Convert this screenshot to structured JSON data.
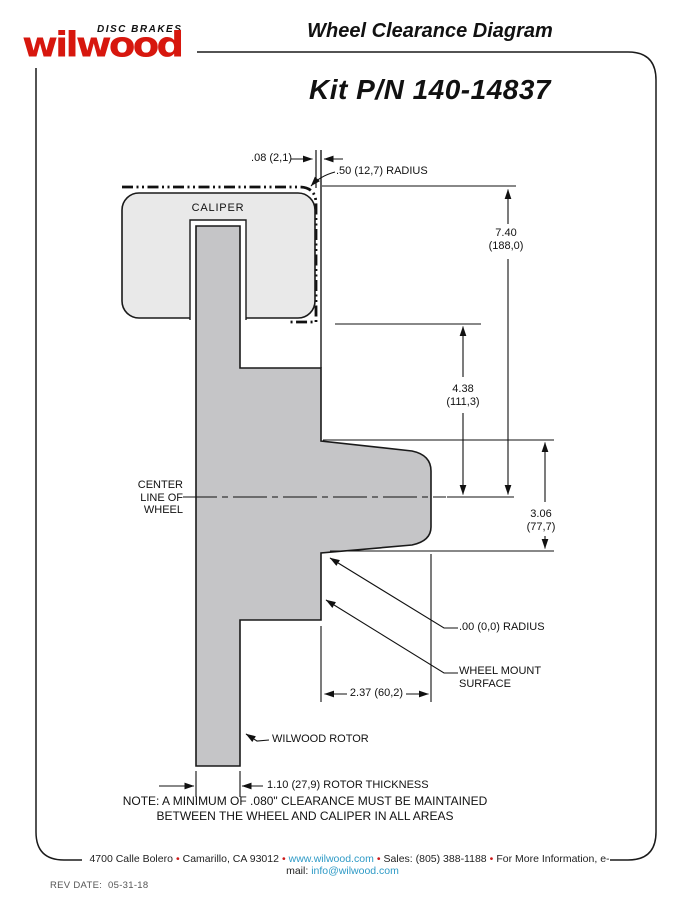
{
  "header": {
    "brand_tagline": "DISC BRAKES",
    "brand_name": "wilwood",
    "doc_title": "Wheel Clearance Diagram",
    "kit_number": "Kit P/N 140-14837"
  },
  "diagram": {
    "caliper_label": "CALIPER",
    "centerline_label": "CENTER\nLINE OF\nWHEEL",
    "rotor_label": "WILWOOD ROTOR",
    "wheel_mount_label": "WHEEL MOUNT\nSURFACE",
    "dims": {
      "clearance_gap": ".08 (2,1)",
      "corner_radius": ".50 (12,7) RADIUS",
      "wheel_radius_in": "7.40",
      "wheel_radius_mm": "(188,0)",
      "caliper_to_center_in": "4.38",
      "caliper_to_center_mm": "(111,3)",
      "hub_pad_in": "3.06",
      "hub_pad_mm": "(77,7)",
      "zero_radius": ".00 (0,0) RADIUS",
      "mount_depth": "2.37 (60,2)",
      "rotor_thickness": "1.10 (27,9) ROTOR THICKNESS"
    },
    "note": "NOTE: A MINIMUM OF .080\" CLEARANCE MUST BE MAINTAINED\nBETWEEN THE WHEEL AND CALIPER IN ALL AREAS"
  },
  "footer": {
    "address": "4700 Calle Bolero",
    "city": "Camarillo, CA 93012",
    "website": "www.wilwood.com",
    "sales": "Sales: (805) 388-1188",
    "more_info": "For More Information, e-mail:",
    "email": "info@wilwood.com",
    "separator": "•",
    "rev_label": "REV DATE:",
    "rev_date": "05-31-18"
  },
  "colors": {
    "brand_red": "#d7170e",
    "link_blue": "#2e9ac6"
  }
}
